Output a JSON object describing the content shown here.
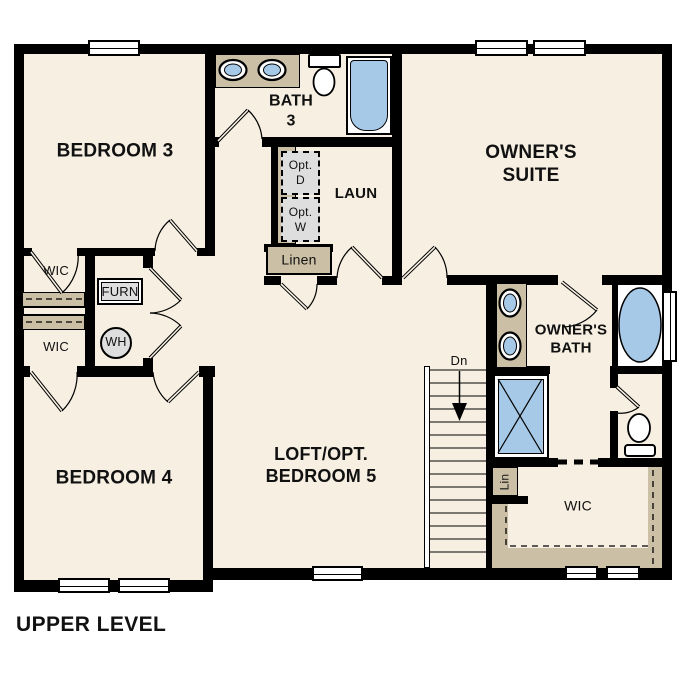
{
  "title": "UPPER LEVEL",
  "colors": {
    "wall": "#000000",
    "floor": "#f6efe2",
    "tan": "#cbbfa5",
    "blue": "#a7c9e8",
    "gray": "#dedede"
  },
  "rooms": {
    "bedroom3": "BEDROOM 3",
    "bath3": "BATH\n3",
    "owners_suite": "OWNER'S\nSUITE",
    "laundry": "LAUN",
    "linen": "Linen",
    "wic_upper": "WIC",
    "wic_lower": "WIC",
    "bedroom4": "BEDROOM 4",
    "loft": "LOFT/OPT.\nBEDROOM 5",
    "owners_bath": "OWNER'S\nBATH",
    "wic_owner": "WIC",
    "lin_closet": "Lin"
  },
  "labels": {
    "furnace": "FURN",
    "water_heater": "WH",
    "opt_dryer": "Opt.\nD",
    "opt_washer": "Opt.\nW",
    "stairs_down": "Dn"
  }
}
